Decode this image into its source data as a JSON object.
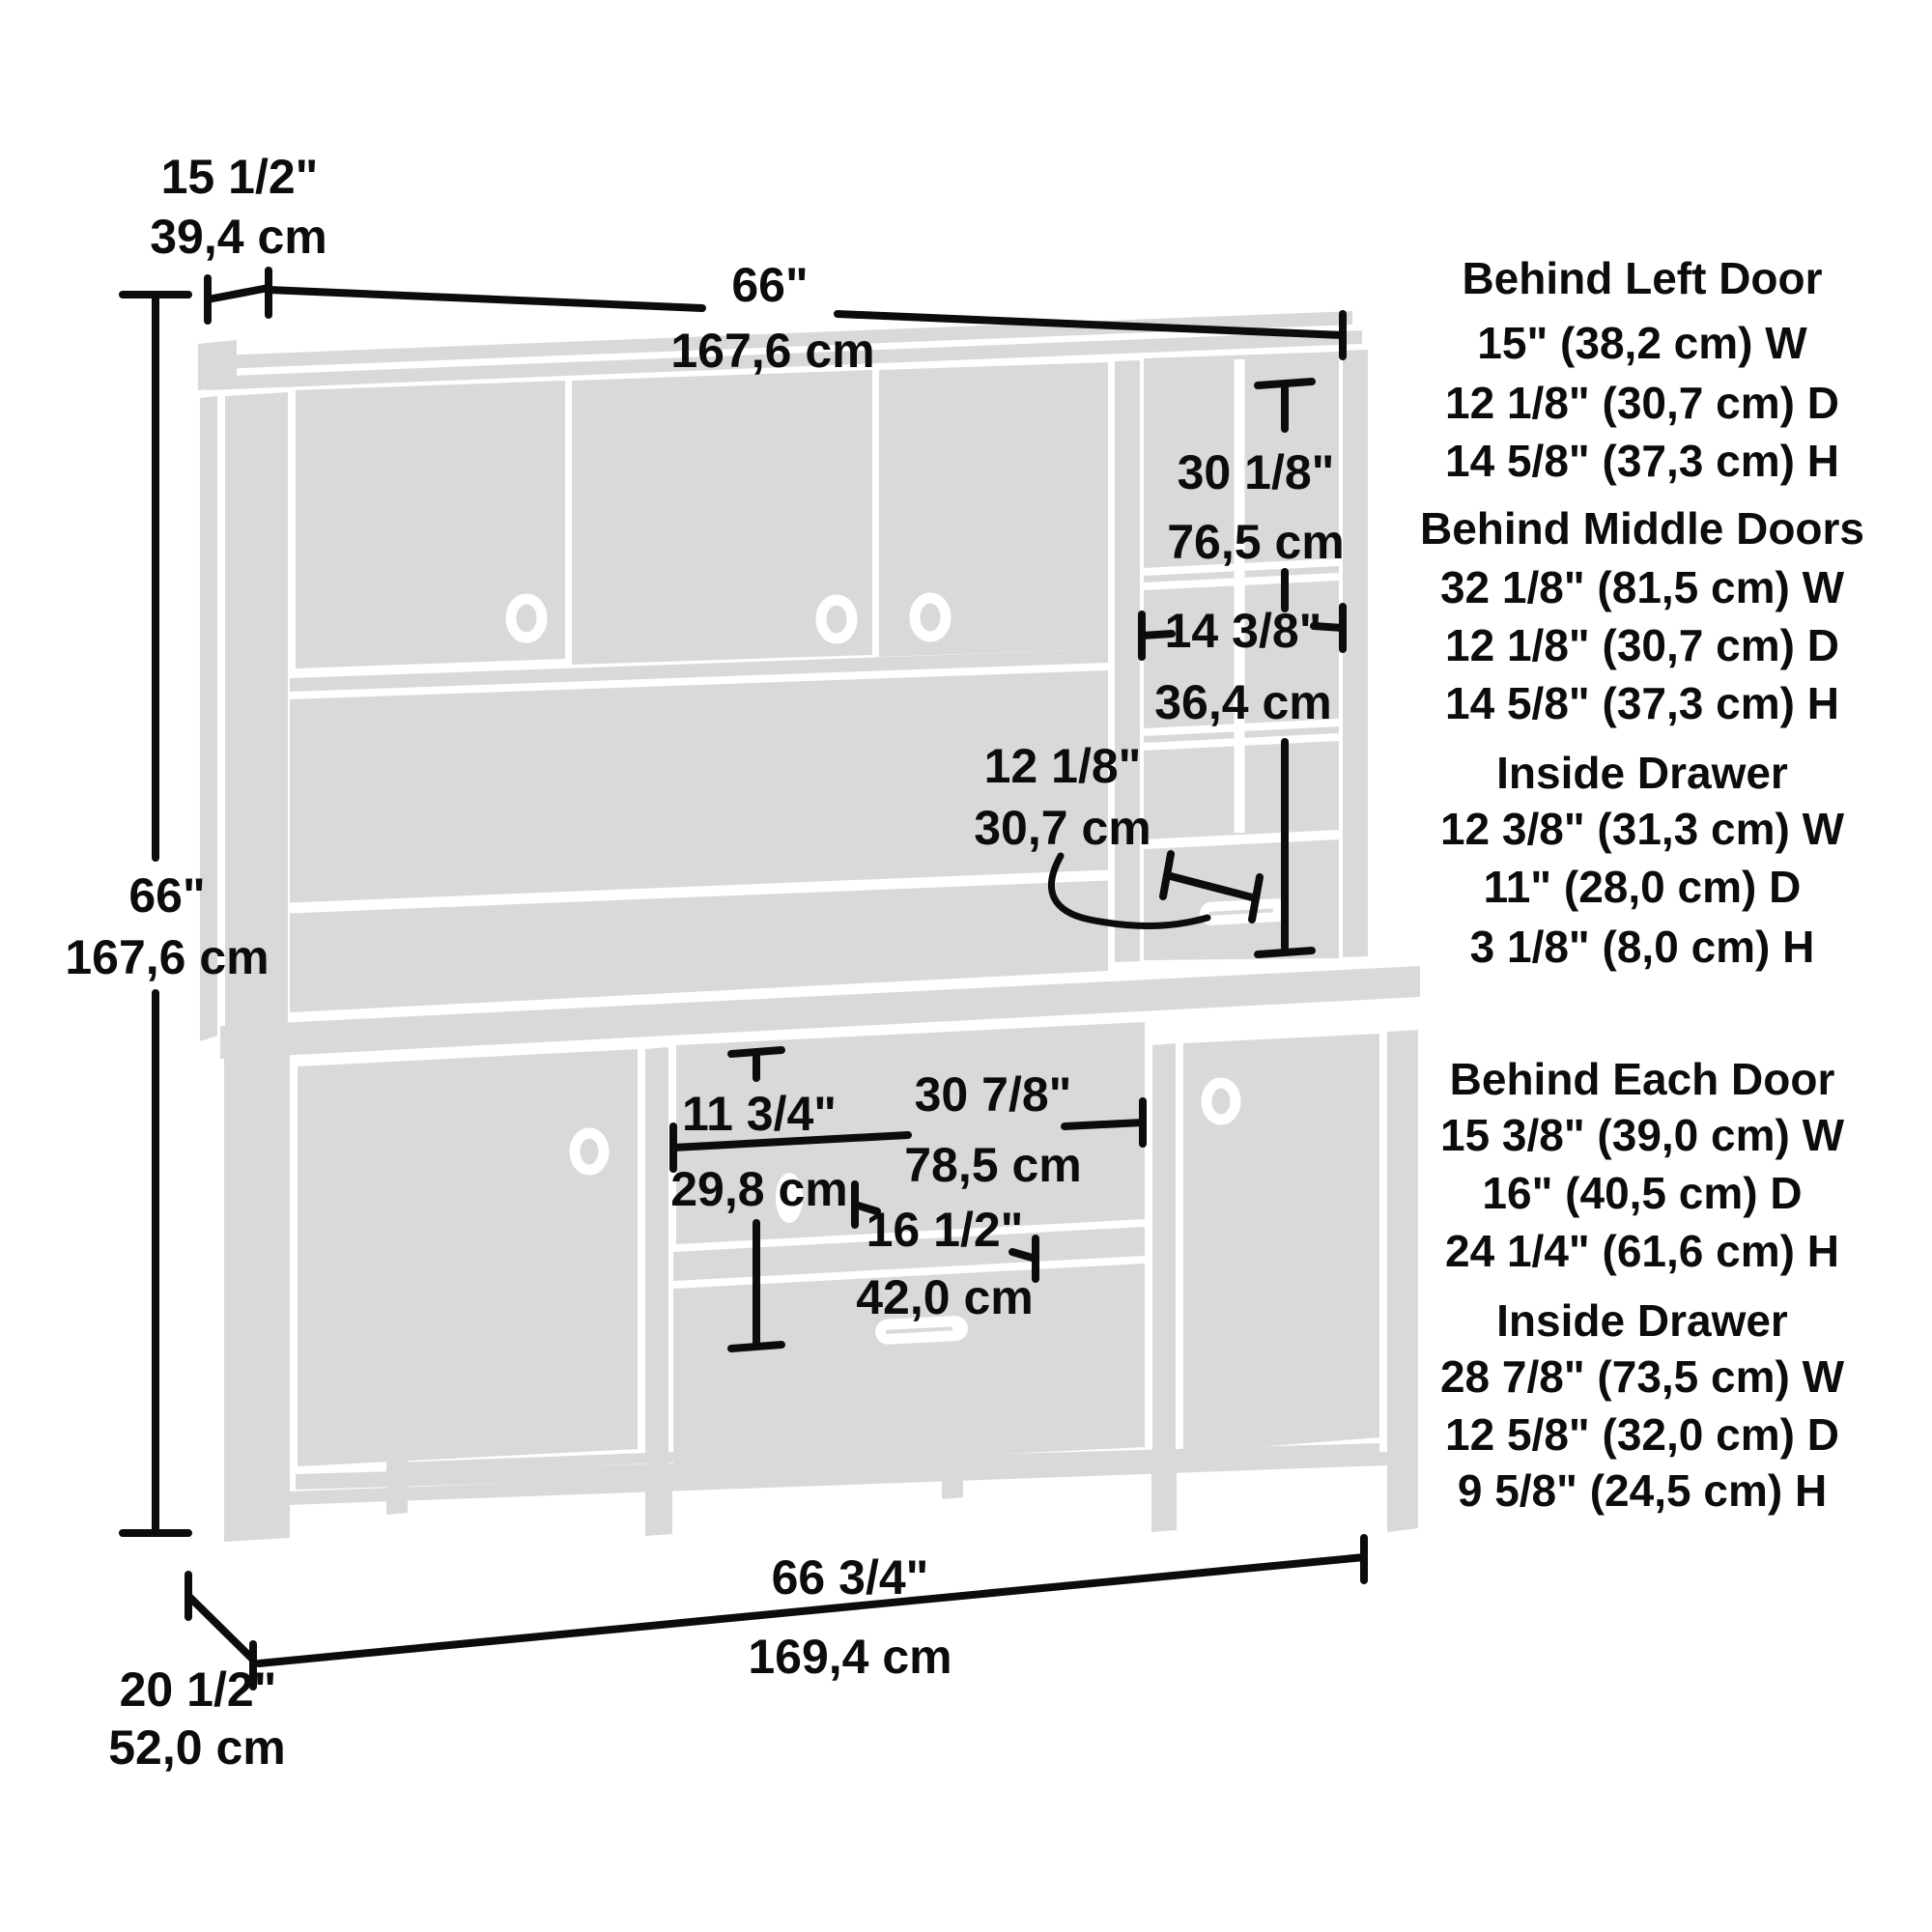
{
  "diagram": {
    "overall": {
      "top_depth_in": "15 1/2\"",
      "top_depth_cm": "39,4 cm",
      "top_width_in": "66\"",
      "top_width_cm": "167,6 cm",
      "height_in": "66\"",
      "height_cm": "167,6 cm",
      "bottom_width_in": "66 3/4\"",
      "bottom_width_cm": "169,4 cm",
      "bottom_depth_in": "20 1/2\"",
      "bottom_depth_cm": "52,0 cm"
    },
    "hutch": {
      "cubby_height_in": "30 1/8\"",
      "cubby_height_cm": "76,5 cm",
      "cubby_width_in": "14 3/8\"",
      "cubby_width_cm": "36,4 cm",
      "cubby_depth_in": "12 1/8\"",
      "cubby_depth_cm": "30,7 cm"
    },
    "desk": {
      "opening_height_in": "11 3/4\"",
      "opening_height_cm": "29,8 cm",
      "opening_width_in": "30 7/8\"",
      "opening_width_cm": "78,5 cm",
      "shelf_depth_in": "16 1/2\"",
      "shelf_depth_cm": "42,0 cm"
    }
  },
  "specs_top": [
    {
      "heading": "Behind Left Door",
      "lines": [
        "15\" (38,2 cm) W",
        "12 1/8\" (30,7 cm) D",
        "14 5/8\" (37,3 cm) H"
      ]
    },
    {
      "heading": "Behind Middle Doors",
      "lines": [
        "32 1/8\" (81,5 cm) W",
        "12 1/8\" (30,7 cm) D",
        "14 5/8\" (37,3 cm) H"
      ]
    },
    {
      "heading": "Inside Drawer",
      "lines": [
        "12 3/8\" (31,3 cm) W",
        "11\" (28,0 cm) D",
        "3 1/8\" (8,0 cm) H"
      ]
    }
  ],
  "specs_bottom": [
    {
      "heading": "Behind Each Door",
      "lines": [
        "15 3/8\" (39,0 cm) W",
        "16\" (40,5 cm) D",
        "24 1/4\" (61,6 cm) H"
      ]
    },
    {
      "heading": "Inside Drawer",
      "lines": [
        "28 7/8\" (73,5 cm) W",
        "12 5/8\" (32,0 cm) D",
        "9 5/8\" (24,5 cm) H"
      ]
    }
  ],
  "colors": {
    "furniture": "#d9d9d9",
    "line": "#000000",
    "background": "#ffffff"
  }
}
